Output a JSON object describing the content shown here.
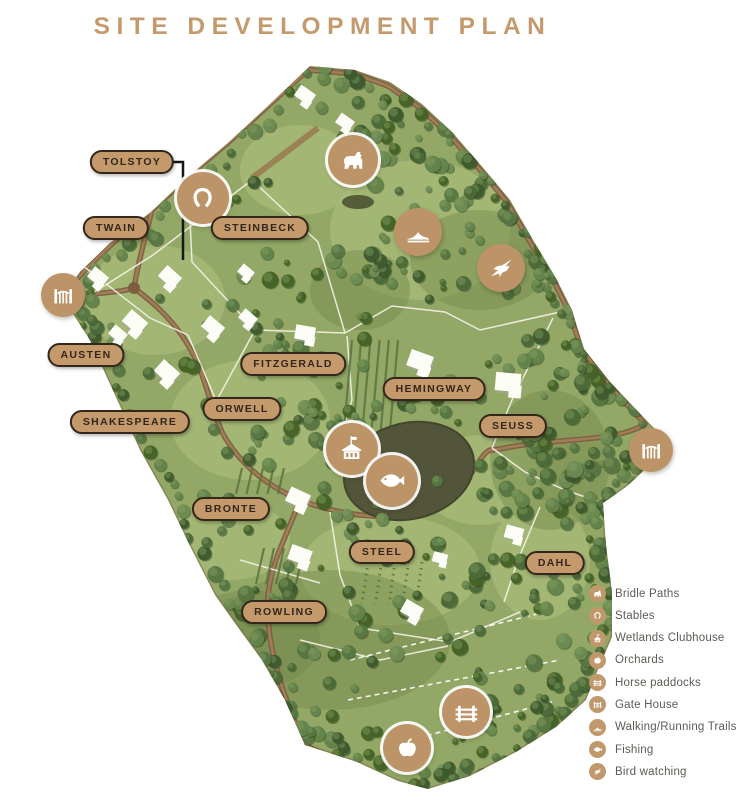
{
  "title": "SITE DEVELOPMENT PLAN",
  "colors": {
    "accent_tan": "#c49a6c",
    "pill_border": "#33261a",
    "pill_text": "#33261b",
    "legend_text": "#5d5b55",
    "map_green": "#93a866"
  },
  "map_labels": [
    {
      "id": "tolstoy",
      "label": "TOLSTOY",
      "x": 132,
      "y": 162
    },
    {
      "id": "twain",
      "label": "TWAIN",
      "x": 116,
      "y": 228
    },
    {
      "id": "steinbeck",
      "label": "STEINBECK",
      "x": 260,
      "y": 228
    },
    {
      "id": "austen",
      "label": "AUSTEN",
      "x": 86,
      "y": 355
    },
    {
      "id": "shakespeare",
      "label": "SHAKESPEARE",
      "x": 130,
      "y": 422
    },
    {
      "id": "orwell",
      "label": "ORWELL",
      "x": 242,
      "y": 409
    },
    {
      "id": "fitzgerald",
      "label": "FITZGERALD",
      "x": 293,
      "y": 364
    },
    {
      "id": "hemingway",
      "label": "HEMINGWAY",
      "x": 434,
      "y": 389
    },
    {
      "id": "seuss",
      "label": "SEUSS",
      "x": 513,
      "y": 426
    },
    {
      "id": "bronte",
      "label": "BRONTE",
      "x": 231,
      "y": 509
    },
    {
      "id": "steel",
      "label": "STEEL",
      "x": 382,
      "y": 552
    },
    {
      "id": "rowling",
      "label": "ROWLING",
      "x": 284,
      "y": 612
    },
    {
      "id": "dahl",
      "label": "DAHL",
      "x": 555,
      "y": 563
    }
  ],
  "map_icons": [
    {
      "id": "stables-marker",
      "type": "horseshoe",
      "x": 203,
      "y": 198,
      "d": 52,
      "ring": true
    },
    {
      "id": "gate-house-west-marker",
      "type": "gate",
      "x": 63,
      "y": 295,
      "d": 44,
      "ring": false
    },
    {
      "id": "bridle-paths-marker",
      "type": "horse",
      "x": 353,
      "y": 160,
      "d": 50,
      "ring": true
    },
    {
      "id": "walking-trails-marker",
      "type": "shoe",
      "x": 418,
      "y": 232,
      "d": 48,
      "ring": false
    },
    {
      "id": "bird-watching-marker",
      "type": "bird",
      "x": 501,
      "y": 268,
      "d": 48,
      "ring": false
    },
    {
      "id": "wetlands-clubhouse-marker",
      "type": "clubhouse",
      "x": 352,
      "y": 449,
      "d": 52,
      "ring": true
    },
    {
      "id": "fishing-marker",
      "type": "fish",
      "x": 392,
      "y": 481,
      "d": 52,
      "ring": true
    },
    {
      "id": "gate-house-east-marker",
      "type": "gate",
      "x": 651,
      "y": 450,
      "d": 44,
      "ring": false
    },
    {
      "id": "horse-paddocks-marker",
      "type": "fence",
      "x": 466,
      "y": 712,
      "d": 48,
      "ring": true
    },
    {
      "id": "orchards-marker",
      "type": "apple",
      "x": 407,
      "y": 748,
      "d": 48,
      "ring": true
    }
  ],
  "legend": {
    "items": [
      {
        "icon": "horse",
        "label": "Bridle Paths"
      },
      {
        "icon": "horseshoe",
        "label": "Stables"
      },
      {
        "icon": "clubhouse",
        "label": "Wetlands Clubhouse"
      },
      {
        "icon": "apple",
        "label": "Orchards"
      },
      {
        "icon": "fence",
        "label": "Horse paddocks"
      },
      {
        "icon": "gate",
        "label": "Gate House"
      },
      {
        "icon": "shoe",
        "label": "Walking/Running Trails"
      },
      {
        "icon": "fish",
        "label": "Fishing"
      },
      {
        "icon": "bird",
        "label": "Bird watching"
      }
    ]
  }
}
